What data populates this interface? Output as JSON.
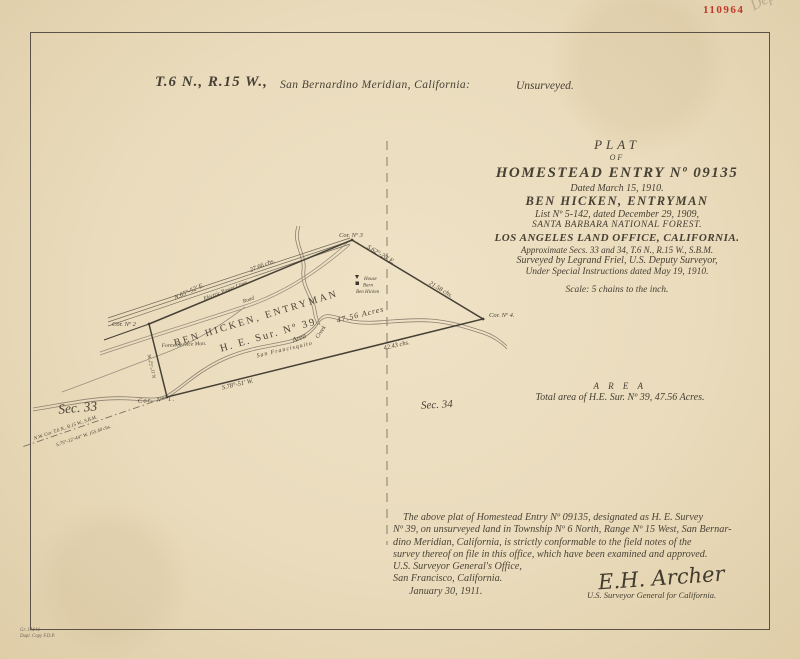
{
  "page": {
    "stamp_number": "110964",
    "pencil_note": "Dep",
    "corner_note_line1": "Gr. J.M.W.",
    "corner_note_line2": "Dupl. Copy F.D.P."
  },
  "header": {
    "township": "T.6 N., R.15 W.,",
    "meridian": "San Bernardino Meridian, California:",
    "status": "Unsurveyed."
  },
  "title_block": {
    "lines": [
      "PLAT",
      "OF",
      "HOMESTEAD ENTRY Nº 09135",
      "Dated March 15, 1910.",
      "BEN HICKEN,  ENTRYMAN",
      "List Nº 5-142, dated December 29, 1909,",
      "SANTA BARBARA NATIONAL FOREST.",
      "LOS ANGELES LAND OFFICE,  CALIFORNIA.",
      "Approximate Secs. 33 and 34, T.6 N., R.15 W., S.B.M.",
      "Surveyed by Legrand Friel, U.S. Deputy Surveyor,",
      "Under Special Instructions dated May 19, 1910.",
      "Scale: 5 chains to the inch."
    ]
  },
  "map": {
    "section_left": "Sec. 33",
    "section_right": "Sec. 34",
    "corner_1": "Cor. Nº 1.",
    "corner_2": "Cor. Nº 2",
    "corner_3": "Cor. Nº 3",
    "corner_4": "Cor. Nº 4.",
    "side_north_bearing": "N.65°-52' E.",
    "side_north_distance": "27.66 chs.",
    "side_east_bearing": "S.62°-20' E.",
    "side_east_distance": "21.58 chs.",
    "side_south_distance": "42.43 chs.",
    "side_south_bearing": "S.78°-51' W.",
    "side_west_bearing": "N.11°-52' W.",
    "tract_line1": "BEN HICKEN, ENTRYMAN",
    "tract_line2": "H. E.  Sur.  Nº 39",
    "area_word": "Area",
    "area_value": "47.56  Acres",
    "creek_name_part1": "San  Francisquito",
    "creek_name_part2": "Creek",
    "power_lines_label": "Electric Power Lines",
    "road_label": "Road",
    "monument_label": "Forest Service Mon.",
    "house_label": "House",
    "barn_label": "Barn",
    "owner_label": "Ben Hicken",
    "tie_line1": "N.W. Cor. T.6 N., R.15 W., S.B.M.",
    "tie_line2": "S.75°-12'-44\" W.  155.40 chs."
  },
  "area_note": {
    "heading": "A R E A",
    "text": "Total area of H.E. Sur. Nº 39,  47.56   Acres."
  },
  "certificate": {
    "lines": [
      "The above plat of Homestead Entry Nº 09135, designated as H. E. Survey",
      "Nº 39, on unsurveyed land in Township Nº 6 North, Range Nº 15 West, San Bernar-",
      "dino Meridian, California, is strictly conformable to the field notes of the",
      "survey thereof on file in this office, which have been examined and approved.",
      "U.S. Surveyor General's Office,",
      "San Francisco, California.",
      "January 30, 1911."
    ]
  },
  "signature": {
    "name": "E.H. Archer",
    "title": "U.S. Surveyor General for California."
  }
}
